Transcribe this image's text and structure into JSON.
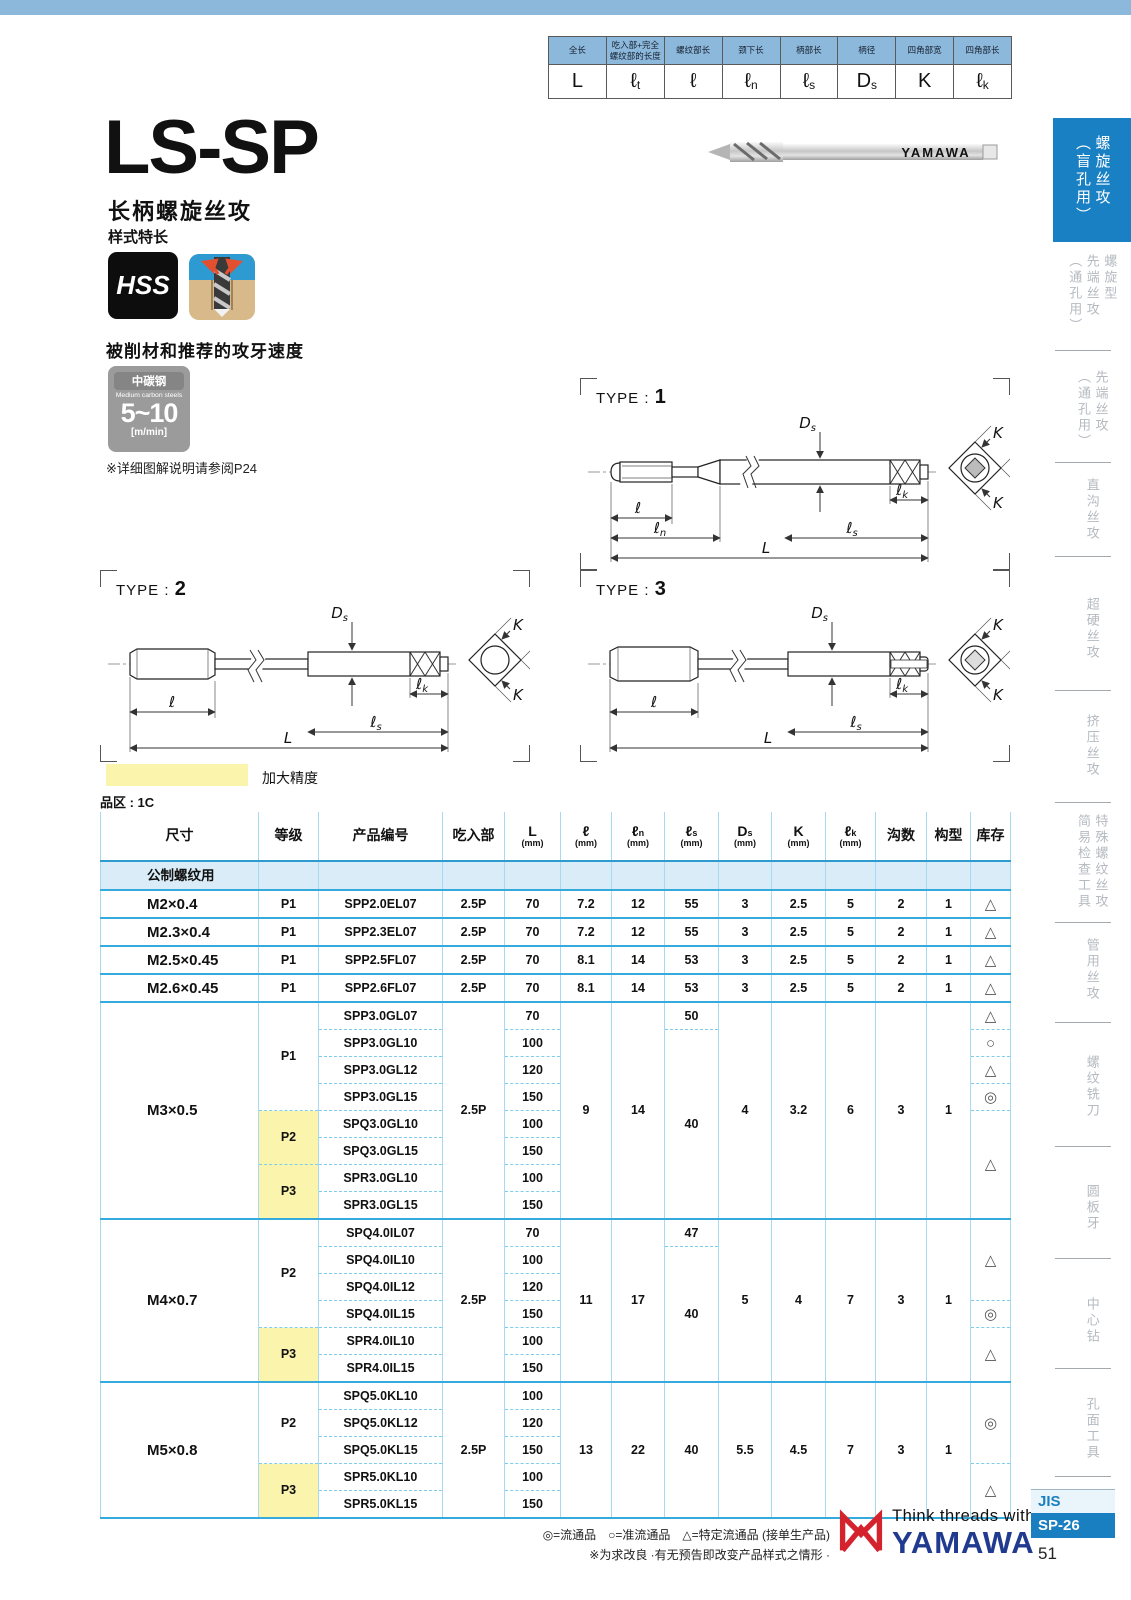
{
  "colors": {
    "band_blue": "#8cb8dc",
    "tab_active_blue": "#1a80c4",
    "table_line_blue": "#35aadd",
    "highlight_yellow": "#faf4ad",
    "brand_blue": "#203a8f",
    "brand_red": "#d5232e",
    "jis_blue": "#1a7fc0"
  },
  "dim_legend": {
    "cols": [
      {
        "label": "全长",
        "sym": "L"
      },
      {
        "label": "吃入部+完全螺纹部的长度",
        "sym": "ℓ",
        "sub": "t"
      },
      {
        "label": "螺纹部长",
        "sym": "ℓ"
      },
      {
        "label": "颈下长",
        "sym": "ℓ",
        "sub": "n"
      },
      {
        "label": "柄部长",
        "sym": "ℓ",
        "sub": "s"
      },
      {
        "label": "柄径",
        "sym": "D",
        "sub": "s"
      },
      {
        "label": "四角部宽",
        "sym": "K"
      },
      {
        "label": "四角部长",
        "sym": "ℓ",
        "sub": "k"
      }
    ]
  },
  "header": {
    "title": "LS-SP",
    "subtitle": "长柄螺旋丝攻",
    "style_note": "样式特长",
    "hss_label": "HSS",
    "photo_brand": "YAMAWA"
  },
  "speed": {
    "heading": "被削材和推荐的攻牙速度",
    "material_cn": "中碳钢",
    "material_en": "Medium carbon steels",
    "range": "5~10",
    "unit": "[m/min]",
    "note": "※详细图解说明请参阅P24"
  },
  "diagrams": {
    "caption": "TYPE :",
    "type1": {
      "num": "1",
      "l": {
        "sym": "ℓ"
      },
      "ln": {
        "sym": "ℓ",
        "sub": "n"
      },
      "ls": {
        "sym": "ℓ",
        "sub": "s"
      },
      "L": {
        "sym": "L"
      },
      "Ds": {
        "sym": "D",
        "sub": "s"
      },
      "lk": {
        "sym": "ℓ",
        "sub": "k"
      },
      "K1": {
        "sym": "K"
      },
      "K2": {
        "sym": "K"
      }
    },
    "type2": {
      "num": "2",
      "l": {
        "sym": "ℓ"
      },
      "ls": {
        "sym": "ℓ",
        "sub": "s"
      },
      "L": {
        "sym": "L"
      },
      "Ds": {
        "sym": "D",
        "sub": "s"
      },
      "lk": {
        "sym": "ℓ",
        "sub": "k"
      },
      "K1": {
        "sym": "K"
      },
      "K2": {
        "sym": "K"
      }
    },
    "type3": {
      "num": "3",
      "l": {
        "sym": "ℓ"
      },
      "ls": {
        "sym": "ℓ",
        "sub": "s"
      },
      "L": {
        "sym": "L"
      },
      "Ds": {
        "sym": "D",
        "sub": "s"
      },
      "lk": {
        "sym": "ℓ",
        "sub": "k"
      },
      "K1": {
        "sym": "K"
      },
      "K2": {
        "sym": "K"
      }
    }
  },
  "legend": {
    "swatch_label": "加大精度",
    "series_label": "品区 : 1C"
  },
  "table": {
    "columns": [
      {
        "label": "尺寸"
      },
      {
        "label": "等级"
      },
      {
        "label": "产品编号"
      },
      {
        "label": "吃入部"
      },
      {
        "label": "L",
        "unit": "(mm)"
      },
      {
        "label": "ℓ",
        "unit": "(mm)"
      },
      {
        "label": "ℓ",
        "sub": "n",
        "unit": "(mm)"
      },
      {
        "label": "ℓ",
        "sub": "s",
        "unit": "(mm)"
      },
      {
        "label": "D",
        "sub": "s",
        "unit": "(mm)"
      },
      {
        "label": "K",
        "unit": "(mm)"
      },
      {
        "label": "ℓ",
        "sub": "k",
        "unit": "(mm)"
      },
      {
        "label": "沟数"
      },
      {
        "label": "构型"
      },
      {
        "label": "库存"
      }
    ],
    "subheader": "公制螺纹用",
    "groups": [
      {
        "size": "M2×0.4",
        "grades": [
          {
            "label": "P1",
            "rows": 1,
            "yellow": false
          }
        ],
        "chamfer": "2.5P",
        "products": [
          {
            "code": "SPP2.0EL07",
            "L": "70"
          }
        ],
        "l": "7.2",
        "ln": "12",
        "ls": [
          {
            "v": "55",
            "rows": 1
          }
        ],
        "ds": "3",
        "k": "2.5",
        "lk": "5",
        "flutes": "2",
        "form": "1",
        "stock": [
          {
            "sym": "△",
            "rows": 1
          }
        ]
      },
      {
        "size": "M2.3×0.4",
        "grades": [
          {
            "label": "P1",
            "rows": 1,
            "yellow": false
          }
        ],
        "chamfer": "2.5P",
        "products": [
          {
            "code": "SPP2.3EL07",
            "L": "70"
          }
        ],
        "l": "7.2",
        "ln": "12",
        "ls": [
          {
            "v": "55",
            "rows": 1
          }
        ],
        "ds": "3",
        "k": "2.5",
        "lk": "5",
        "flutes": "2",
        "form": "1",
        "stock": [
          {
            "sym": "△",
            "rows": 1
          }
        ]
      },
      {
        "size": "M2.5×0.45",
        "grades": [
          {
            "label": "P1",
            "rows": 1,
            "yellow": false
          }
        ],
        "chamfer": "2.5P",
        "products": [
          {
            "code": "SPP2.5FL07",
            "L": "70"
          }
        ],
        "l": "8.1",
        "ln": "14",
        "ls": [
          {
            "v": "53",
            "rows": 1
          }
        ],
        "ds": "3",
        "k": "2.5",
        "lk": "5",
        "flutes": "2",
        "form": "1",
        "stock": [
          {
            "sym": "△",
            "rows": 1
          }
        ]
      },
      {
        "size": "M2.6×0.45",
        "grades": [
          {
            "label": "P1",
            "rows": 1,
            "yellow": false
          }
        ],
        "chamfer": "2.5P",
        "products": [
          {
            "code": "SPP2.6FL07",
            "L": "70"
          }
        ],
        "l": "8.1",
        "ln": "14",
        "ls": [
          {
            "v": "53",
            "rows": 1
          }
        ],
        "ds": "3",
        "k": "2.5",
        "lk": "5",
        "flutes": "2",
        "form": "1",
        "stock": [
          {
            "sym": "△",
            "rows": 1
          }
        ]
      },
      {
        "size": "M3×0.5",
        "grades": [
          {
            "label": "P1",
            "rows": 4,
            "yellow": false
          },
          {
            "label": "P2",
            "rows": 2,
            "yellow": true
          },
          {
            "label": "P3",
            "rows": 2,
            "yellow": true
          }
        ],
        "chamfer": "2.5P",
        "products": [
          {
            "code": "SPP3.0GL07",
            "L": "70"
          },
          {
            "code": "SPP3.0GL10",
            "L": "100"
          },
          {
            "code": "SPP3.0GL12",
            "L": "120"
          },
          {
            "code": "SPP3.0GL15",
            "L": "150"
          },
          {
            "code": "SPQ3.0GL10",
            "L": "100"
          },
          {
            "code": "SPQ3.0GL15",
            "L": "150"
          },
          {
            "code": "SPR3.0GL10",
            "L": "100"
          },
          {
            "code": "SPR3.0GL15",
            "L": "150"
          }
        ],
        "l": "9",
        "ln": "14",
        "ls": [
          {
            "v": "50",
            "rows": 1
          },
          {
            "v": "40",
            "rows": 7
          }
        ],
        "ds": "4",
        "k": "3.2",
        "lk": "6",
        "flutes": "3",
        "form": "1",
        "stock": [
          {
            "sym": "△",
            "rows": 1
          },
          {
            "sym": "○",
            "rows": 1
          },
          {
            "sym": "△",
            "rows": 1
          },
          {
            "sym": "◎",
            "rows": 1
          },
          {
            "sym": "△",
            "rows": 4
          }
        ]
      },
      {
        "size": "M4×0.7",
        "grades": [
          {
            "label": "P2",
            "rows": 4,
            "yellow": false
          },
          {
            "label": "P3",
            "rows": 2,
            "yellow": true
          }
        ],
        "chamfer": "2.5P",
        "products": [
          {
            "code": "SPQ4.0IL07",
            "L": "70"
          },
          {
            "code": "SPQ4.0IL10",
            "L": "100"
          },
          {
            "code": "SPQ4.0IL12",
            "L": "120"
          },
          {
            "code": "SPQ4.0IL15",
            "L": "150"
          },
          {
            "code": "SPR4.0IL10",
            "L": "100"
          },
          {
            "code": "SPR4.0IL15",
            "L": "150"
          }
        ],
        "l": "11",
        "ln": "17",
        "ls": [
          {
            "v": "47",
            "rows": 1
          },
          {
            "v": "40",
            "rows": 5
          }
        ],
        "ds": "5",
        "k": "4",
        "lk": "7",
        "flutes": "3",
        "form": "1",
        "stock": [
          {
            "sym": "△",
            "rows": 3
          },
          {
            "sym": "◎",
            "rows": 1
          },
          {
            "sym": "△",
            "rows": 2
          }
        ]
      },
      {
        "size": "M5×0.8",
        "grades": [
          {
            "label": "P2",
            "rows": 3,
            "yellow": false
          },
          {
            "label": "P3",
            "rows": 2,
            "yellow": true
          }
        ],
        "chamfer": "2.5P",
        "products": [
          {
            "code": "SPQ5.0KL10",
            "L": "100"
          },
          {
            "code": "SPQ5.0KL12",
            "L": "120"
          },
          {
            "code": "SPQ5.0KL15",
            "L": "150"
          },
          {
            "code": "SPR5.0KL10",
            "L": "100"
          },
          {
            "code": "SPR5.0KL15",
            "L": "150"
          }
        ],
        "l": "13",
        "ln": "22",
        "ls": [
          {
            "v": "40",
            "rows": 5
          }
        ],
        "ds": "5.5",
        "k": "4.5",
        "lk": "7",
        "flutes": "3",
        "form": "1",
        "stock": [
          {
            "sym": "◎",
            "rows": 3
          },
          {
            "sym": "△",
            "rows": 2
          }
        ]
      }
    ]
  },
  "footer": {
    "symbols": "◎=流通品　○=准流通品　△=特定流通品 (接单生产品)",
    "note": "※为求改良 ·有无预告即改变产品样式之情形 ·",
    "tagline": "Think threads with",
    "brand": "YAMAWA",
    "jis": "JIS",
    "code": "SP-26",
    "page": "51"
  },
  "sidebar": {
    "tabs": [
      {
        "lines": [
          "螺旋丝攻",
          "（盲孔用）"
        ],
        "active": true
      },
      {
        "lines": [
          "螺旋型",
          "先端丝攻",
          "（通孔用）"
        ],
        "active": false
      },
      {
        "lines": [
          "先端丝攻",
          "（通孔用）"
        ],
        "active": false
      },
      {
        "lines": [
          "直沟丝攻"
        ],
        "active": false
      },
      {
        "lines": [
          "超硬丝攻"
        ],
        "active": false
      },
      {
        "lines": [
          "挤压丝攻"
        ],
        "active": false
      },
      {
        "lines": [
          "特殊螺纹丝攻",
          "简易检查工具"
        ],
        "active": false
      },
      {
        "lines": [
          "管用丝攻"
        ],
        "active": false
      },
      {
        "lines": [
          "螺纹铣刀"
        ],
        "active": false
      },
      {
        "lines": [
          "圆板牙"
        ],
        "active": false
      },
      {
        "lines": [
          "中心钻"
        ],
        "active": false
      },
      {
        "lines": [
          "孔面工具"
        ],
        "active": false
      }
    ]
  }
}
